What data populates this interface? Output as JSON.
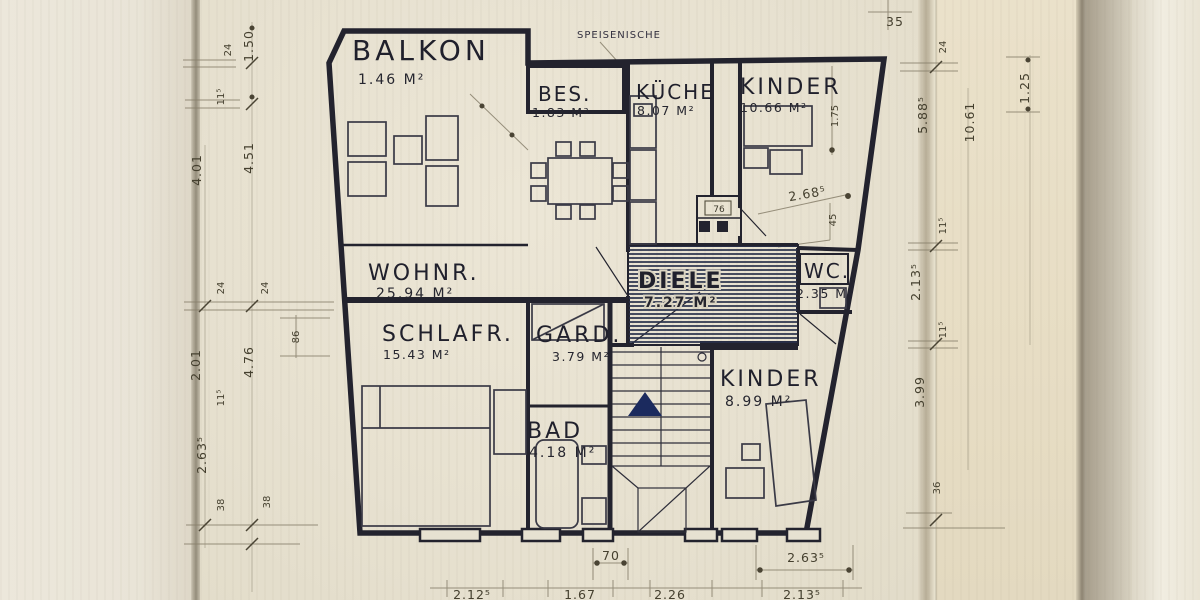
{
  "rooms": [
    {
      "id": "balkon",
      "name": "BALKON",
      "area": "1.46 M²"
    },
    {
      "id": "bes",
      "name": "BES.",
      "area": "1.83 M²"
    },
    {
      "id": "kueche",
      "name": "KÜCHE",
      "area": "8.07 M²"
    },
    {
      "id": "kinder-top",
      "name": "KINDER",
      "area": "10.66 M²"
    },
    {
      "id": "wohnraum",
      "name": "WOHNR.",
      "area": "25.94 M²"
    },
    {
      "id": "diele",
      "name": "DIELE",
      "area": "7.27 M²"
    },
    {
      "id": "wc",
      "name": "WC.",
      "area": "2.35 M²"
    },
    {
      "id": "schlafzimmer",
      "name": "SCHLAFR.",
      "area": "15.43 M²"
    },
    {
      "id": "garderobe",
      "name": "GARD.",
      "area": "3.79 M²"
    },
    {
      "id": "kinder-bottom",
      "name": "KINDER",
      "area": "8.99 M²"
    },
    {
      "id": "bad",
      "name": "BAD",
      "area": "4.18 M²"
    }
  ],
  "annotations": {
    "speisenische": "SPEISENISCHE"
  },
  "dims": {
    "left": [
      "1.50",
      "24",
      "11⁵",
      "4.51",
      "4.01",
      "24",
      "24",
      "4.76",
      "86",
      "2.01",
      "11⁵",
      "2.63⁵",
      "38",
      "38"
    ],
    "right": [
      "35",
      "24",
      "5.88⁵",
      "10.61",
      "1.25",
      "11⁵",
      "2.13⁵",
      "11⁵",
      "3.99",
      "36"
    ],
    "bottom": [
      "70",
      "2.63⁵",
      "2.12⁵",
      "1.67",
      "2.26",
      "2.13⁵"
    ],
    "interior": [
      "2.68⁵",
      "1.75",
      "45",
      "76"
    ]
  },
  "colors": {
    "paper": "#e8e2d1",
    "ink": "#23232e",
    "hatch": "#28304a",
    "stair_arrow": "#1b2a5e",
    "pencil": "#6b6353"
  }
}
